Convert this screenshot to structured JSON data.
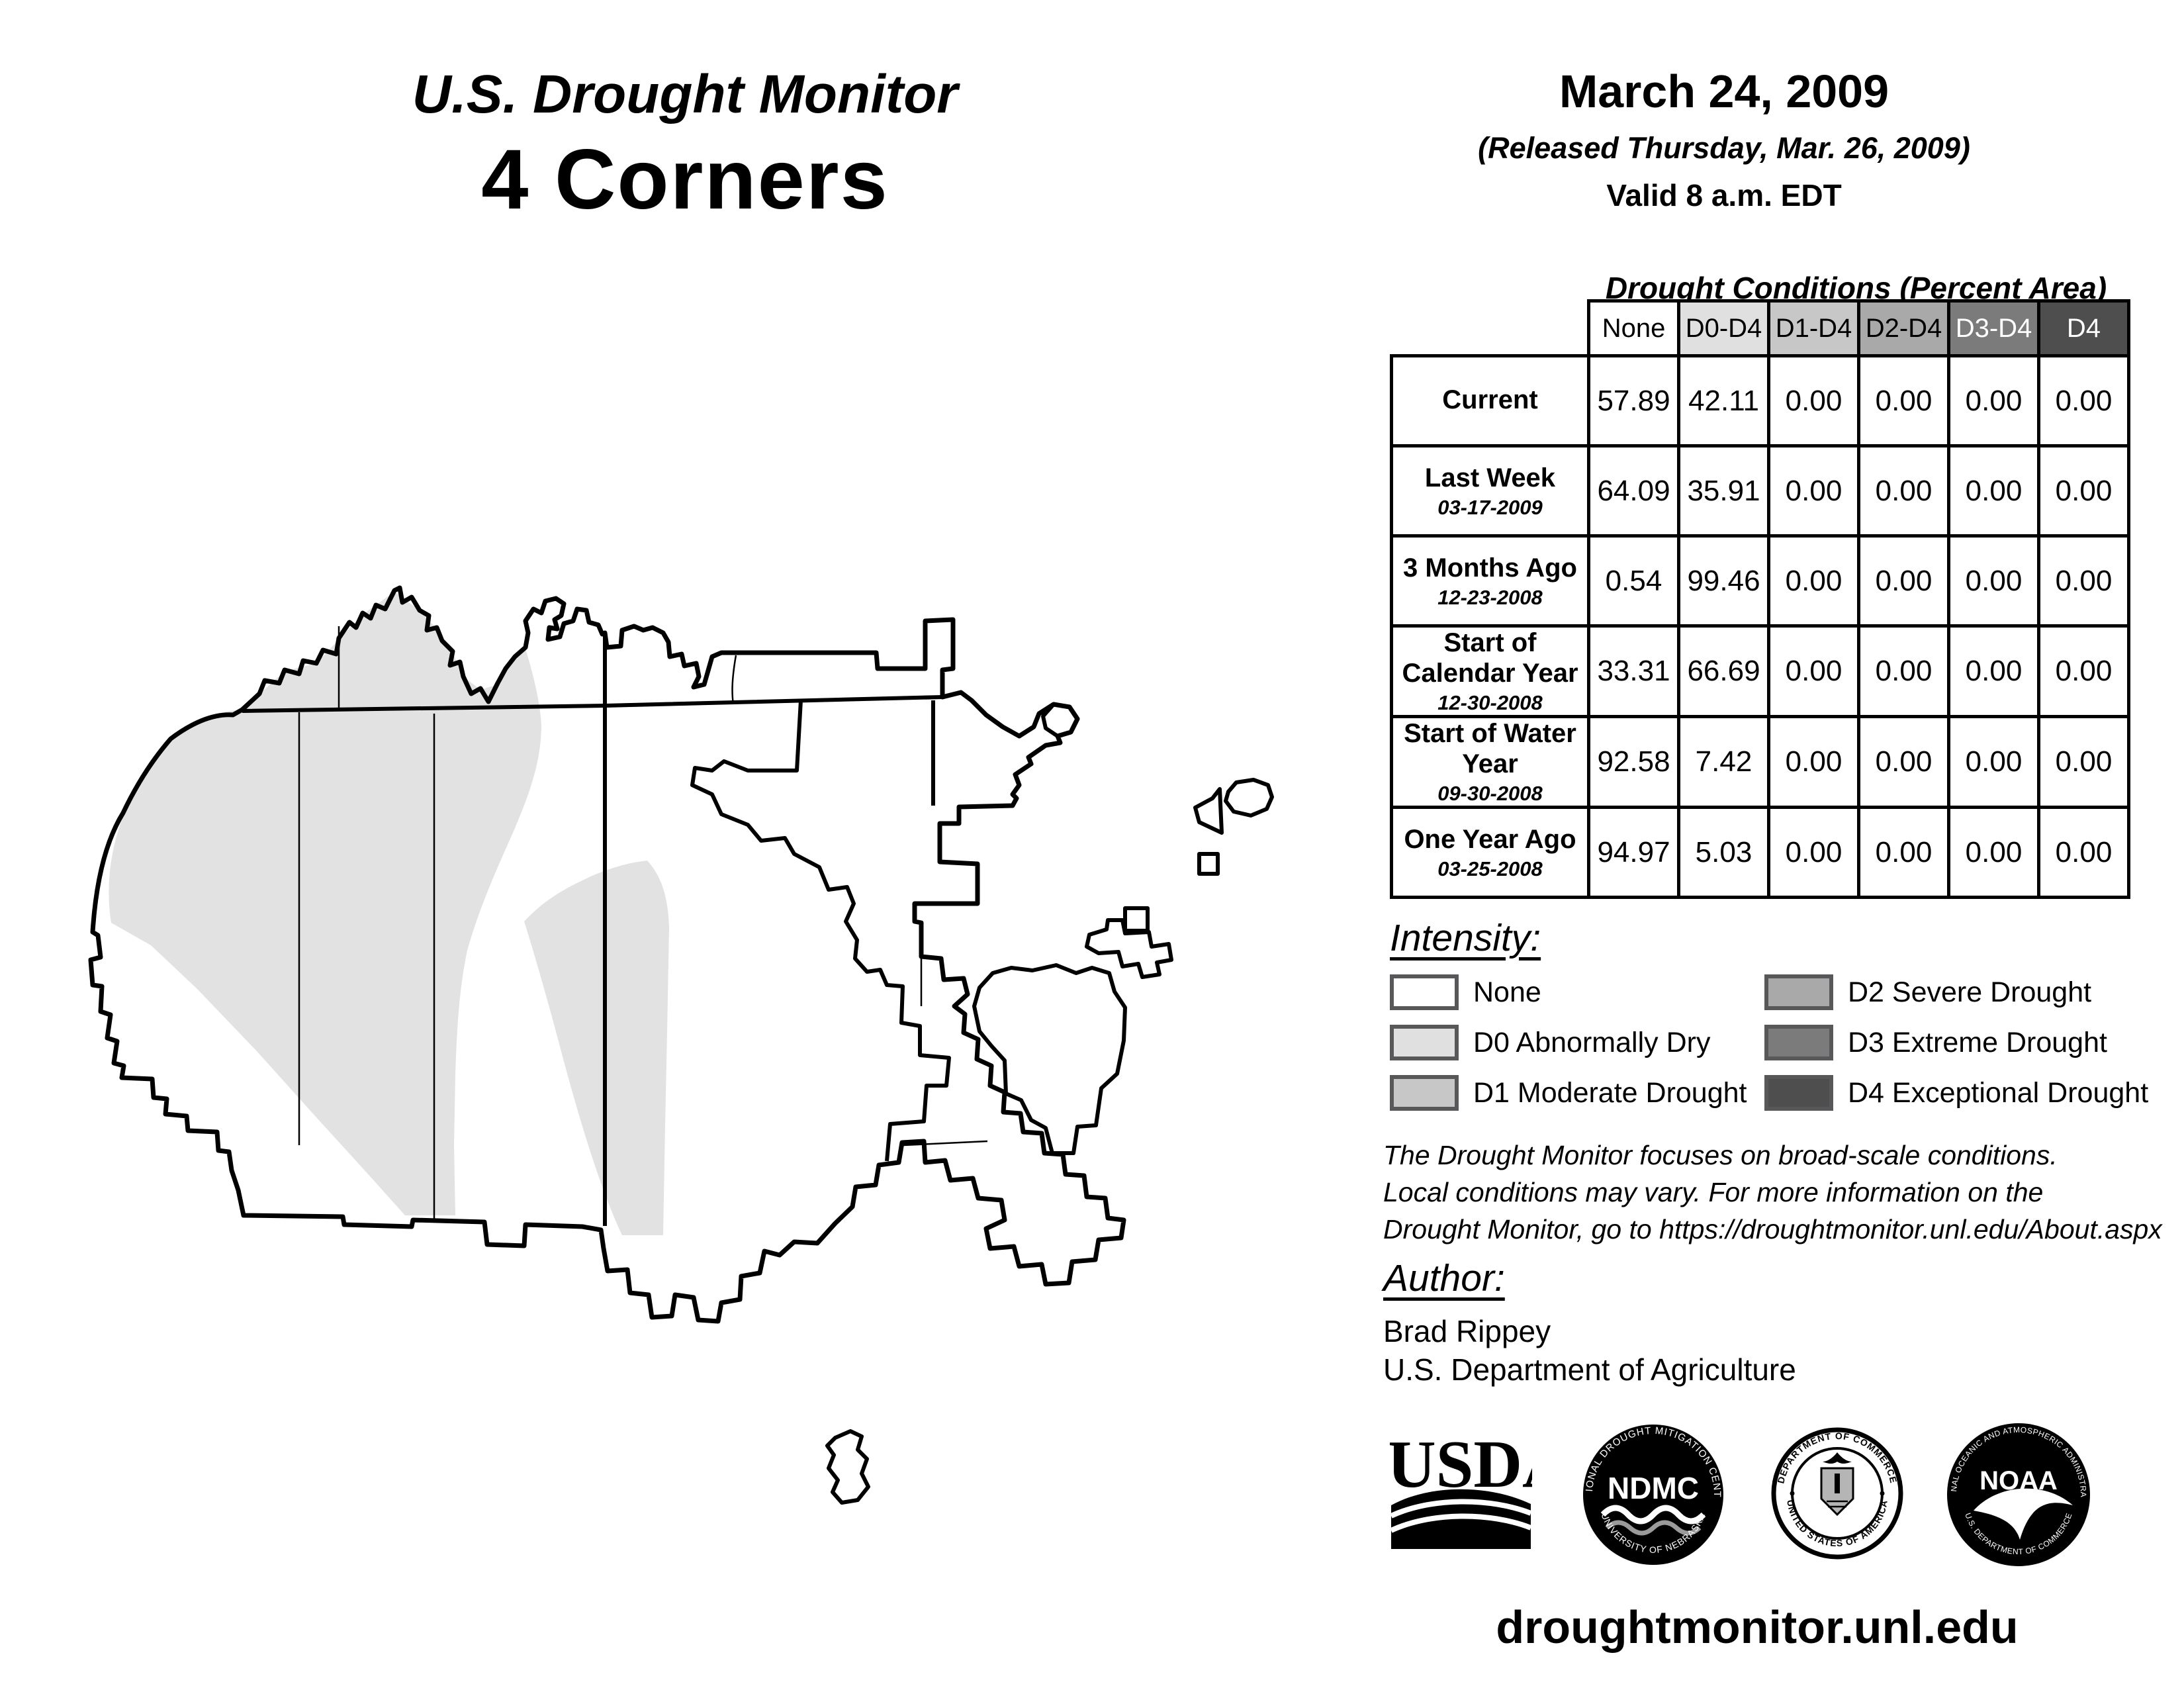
{
  "page": {
    "title": "U.S. Drought Monitor",
    "region": "4 Corners"
  },
  "release": {
    "map_date": "March 24, 2009",
    "released": "(Released Thursday, Mar. 26, 2009)",
    "valid": "Valid 8 a.m. EDT"
  },
  "table": {
    "title": "Drought Conditions (Percent Area)",
    "columns": [
      "None",
      "D0-D4",
      "D1-D4",
      "D2-D4",
      "D3-D4",
      "D4"
    ],
    "header_colors": [
      "#ffffff",
      "#e0e0e0",
      "#c7c7c7",
      "#a9a9a9",
      "#7b7b7b",
      "#4e4e4e"
    ],
    "header_text_colors": [
      "#000000",
      "#000000",
      "#000000",
      "#000000",
      "#ffffff",
      "#ffffff"
    ],
    "rows": [
      {
        "label": "Current",
        "date": "",
        "values": [
          "57.89",
          "42.11",
          "0.00",
          "0.00",
          "0.00",
          "0.00"
        ]
      },
      {
        "label": "Last Week",
        "date": "03-17-2009",
        "values": [
          "64.09",
          "35.91",
          "0.00",
          "0.00",
          "0.00",
          "0.00"
        ]
      },
      {
        "label": "3 Months Ago",
        "date": "12-23-2008",
        "values": [
          "0.54",
          "99.46",
          "0.00",
          "0.00",
          "0.00",
          "0.00"
        ]
      },
      {
        "label": "Start of Calendar Year",
        "date": "12-30-2008",
        "values": [
          "33.31",
          "66.69",
          "0.00",
          "0.00",
          "0.00",
          "0.00"
        ]
      },
      {
        "label": "Start of Water Year",
        "date": "09-30-2008",
        "values": [
          "92.58",
          "7.42",
          "0.00",
          "0.00",
          "0.00",
          "0.00"
        ]
      },
      {
        "label": "One Year Ago",
        "date": "03-25-2008",
        "values": [
          "94.97",
          "5.03",
          "0.00",
          "0.00",
          "0.00",
          "0.00"
        ]
      }
    ]
  },
  "legend": {
    "title": "Intensity:",
    "items": [
      {
        "label": "None",
        "color": "#ffffff"
      },
      {
        "label": "D0 Abnormally Dry",
        "color": "#e0e0e0"
      },
      {
        "label": "D1 Moderate Drought",
        "color": "#c7c7c7"
      },
      {
        "label": "D2 Severe Drought",
        "color": "#a9a9a9"
      },
      {
        "label": "D3 Extreme Drought",
        "color": "#7b7b7b"
      },
      {
        "label": "D4 Exceptional Drought",
        "color": "#4e4e4e"
      }
    ]
  },
  "notes": {
    "line1": "The Drought Monitor focuses on broad-scale conditions.",
    "line2": "Local conditions may vary. For more information on the",
    "line3": "Drought Monitor, go to https://droughtmonitor.unl.edu/About.aspx"
  },
  "author": {
    "title": "Author:",
    "name": "Brad Rippey",
    "org": "U.S. Department of Agriculture"
  },
  "logos": {
    "usda": {
      "text": "USDA"
    },
    "ndmc": {
      "top": "NATIONAL DROUGHT MITIGATION CENTER",
      "center": "NDMC",
      "bottom": "UNIVERSITY OF NEBRASKA"
    },
    "doc": {
      "top": "DEPARTMENT OF COMMERCE",
      "bottom": "UNITED STATES OF AMERICA"
    },
    "noaa": {
      "top": "NATIONAL OCEANIC AND ATMOSPHERIC ADMINISTRATION",
      "center": "NOAA",
      "bottom": "U.S. DEPARTMENT OF COMMERCE"
    }
  },
  "footer": {
    "url": "droughtmonitor.unl.edu"
  },
  "map": {
    "d0_color": "#e2e2e2",
    "line_color": "#000000"
  }
}
